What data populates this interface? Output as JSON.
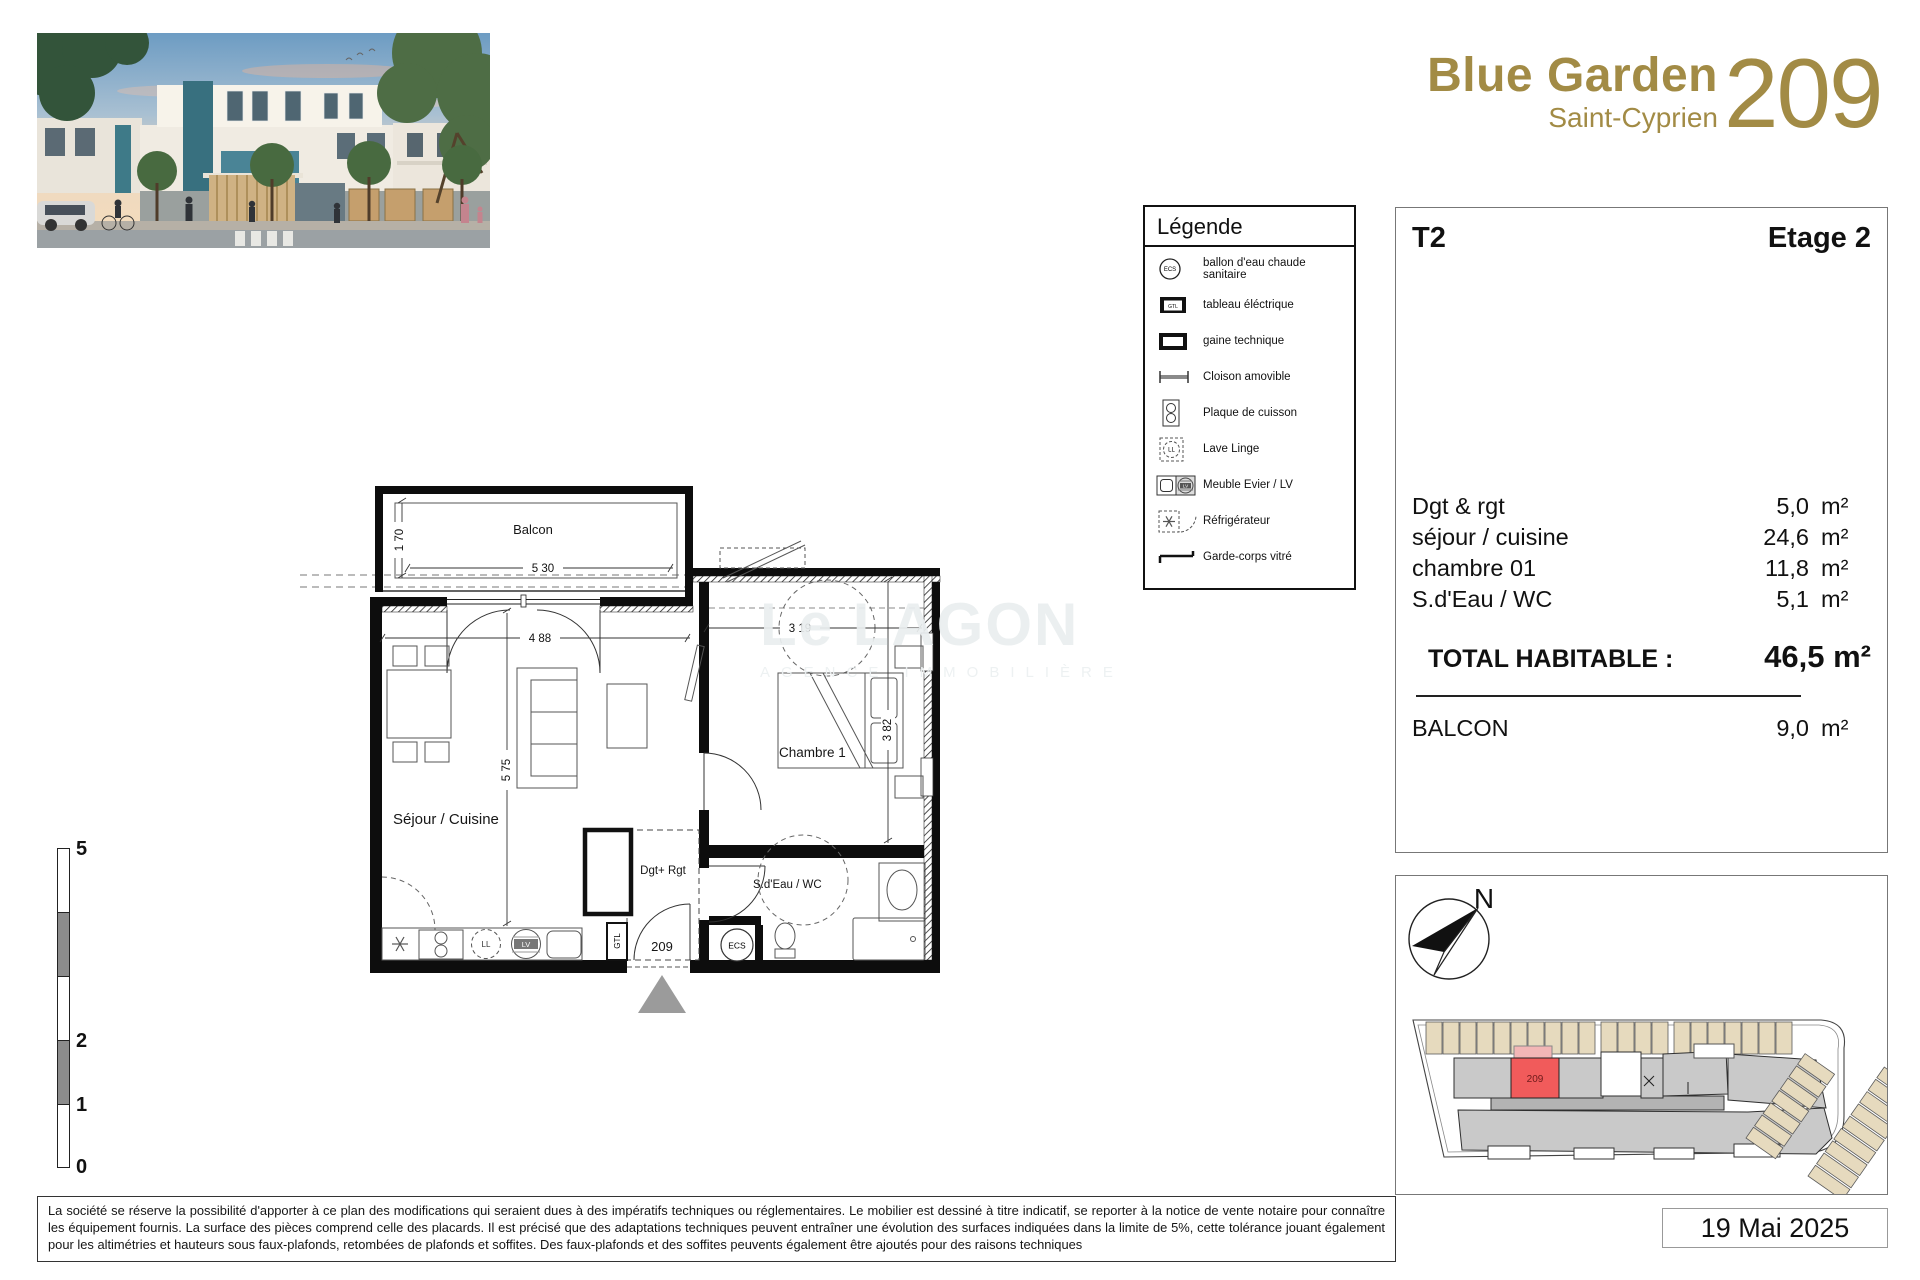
{
  "header": {
    "project_name": "Blue Garden",
    "location": "Saint-Cyprien",
    "unit_number": "209"
  },
  "legend": {
    "title": "Légende",
    "items": [
      {
        "icon": "water-heater-icon",
        "label": "ballon d'eau chaude sanitaire"
      },
      {
        "icon": "electrical-panel-icon",
        "label": "tableau éléctrique"
      },
      {
        "icon": "technical-duct-icon",
        "label": "gaine technique"
      },
      {
        "icon": "movable-partition-icon",
        "label": "Cloison amovible"
      },
      {
        "icon": "cooktop-icon",
        "label": "Plaque de cuisson"
      },
      {
        "icon": "washing-machine-icon",
        "label": "Lave Linge"
      },
      {
        "icon": "sink-dishwasher-icon",
        "label": "Meuble Evier / LV"
      },
      {
        "icon": "refrigerator-icon",
        "label": "Réfrigérateur"
      },
      {
        "icon": "glass-railing-icon",
        "label": "Garde-corps vitré"
      }
    ],
    "icon_texts": {
      "ecs": "ECS",
      "gtl": "GTL",
      "ll": "LL",
      "lv": "LV"
    }
  },
  "info_panel": {
    "type": "T2",
    "floor": "Etage 2",
    "rooms": [
      {
        "name": "Dgt & rgt",
        "area": "5,0",
        "unit": "m²"
      },
      {
        "name": "séjour / cuisine",
        "area": "24,6",
        "unit": "m²"
      },
      {
        "name": "chambre 01",
        "area": "11,8",
        "unit": "m²"
      },
      {
        "name": "S.d'Eau / WC",
        "area": "5,1",
        "unit": "m²"
      }
    ],
    "total_label": "TOTAL HABITABLE :",
    "total_value": "46,5 m²",
    "balcony": {
      "name": "BALCON",
      "area": "9,0",
      "unit": "m²"
    }
  },
  "floor_plan": {
    "room_labels": {
      "balcony": "Balcon",
      "living": "Séjour / Cuisine",
      "bedroom": "Chambre 1",
      "bathroom": "S.d'Eau / WC",
      "storage": "Dgt+ Rgt"
    },
    "equipment_labels": {
      "gtl": "GTL",
      "ecs": "ECS",
      "washer": "LL",
      "dishwasher": "LV"
    },
    "unit_number": "209",
    "dimensions": {
      "balcony_depth": "1 70",
      "balcony_width": "5 30",
      "living_width": "4 88",
      "living_depth": "5 75",
      "bedroom_width": "3 19",
      "bedroom_depth": "3 82"
    }
  },
  "watermark": {
    "line1": "Le LAGON",
    "line2": "AGENCE IMMOBILIÈRE"
  },
  "scale_bar": {
    "labels": [
      "5",
      "2",
      "1",
      "0"
    ]
  },
  "site_plan": {
    "north_label": "N",
    "unit_number": "209"
  },
  "footer": {
    "disclaimer": "La société se réserve la possibilité d'apporter à ce plan des modifications qui seraient dues à des impératifs techniques ou réglementaires. Le mobilier est dessiné à titre indicatif, se reporter à la notice de vente notaire pour connaître les équipement fournis. La surface des pièces comprend celle des placards. Il est précisé que des adaptations techniques peuvent entraîner une évolution des surfaces indiquées dans la limite de 5%, cette tolérance jouant également pour les altimétries et hauteurs sous faux-plafonds, retombées de plafonds et soffites. Des faux-plafonds et des soffites peuvents également être ajoutés pour des raisons techniques",
    "date": "19 Mai 2025"
  },
  "colors": {
    "accent_gold": "#a28b45",
    "unit_highlight": "#f15b5b",
    "parking": "#e6dabe",
    "building_gray": "#c9c9c9"
  }
}
